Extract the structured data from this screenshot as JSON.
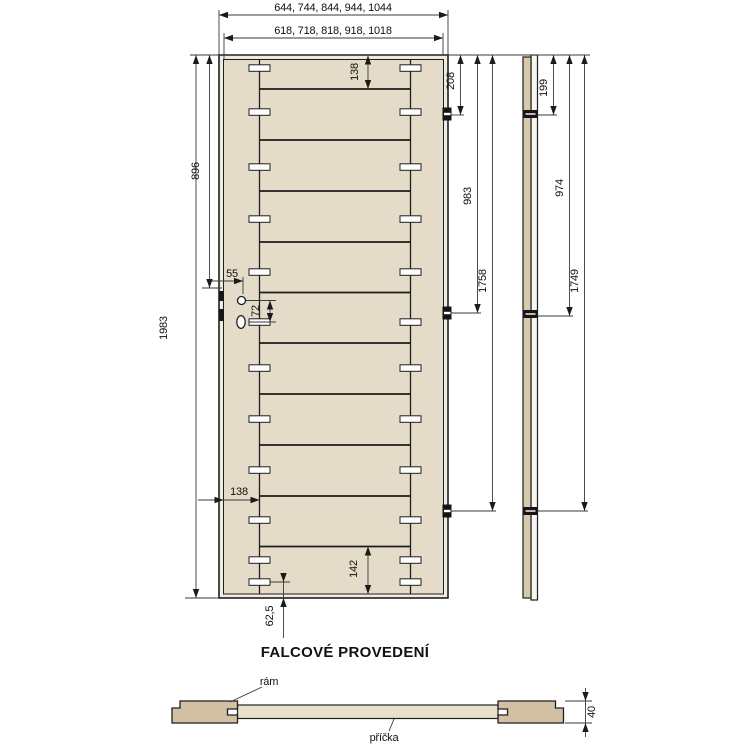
{
  "title": "FALCOVÉ PROVEDENÍ",
  "front_view": {
    "dim_width_outer": "644, 744, 844, 944, 1044",
    "dim_width_inner": "618, 718, 818, 918, 1018",
    "dim_height": "1983",
    "dim_top_to_lock": "896",
    "dim_lock_backset": "55",
    "dim_handle_to_key": "72",
    "dim_top_rail": "138",
    "dim_stile_width": "138",
    "dim_bottom_rail": "142",
    "dim_bottom_dowel": "62,5",
    "hinge_dims": [
      "208",
      "983",
      "1758"
    ]
  },
  "side_view": {
    "hinge_dims": [
      "199",
      "974",
      "1749"
    ]
  },
  "section_view": {
    "dim_thickness": "40",
    "label_frame": "rám",
    "label_partition": "příčka"
  },
  "colors": {
    "background": "#ffffff",
    "line": "#1f1f1f",
    "dim_line": "#3a3a3a",
    "door_face": "#e4dcc9",
    "falc_band": "#f0ebdf",
    "section_frame": "#d3c0a3",
    "section_partition": "#e9e0cc",
    "side_strip_wood": "#d7c9ab",
    "side_strip_falc": "#f8f6f0",
    "hardware": "#151515"
  }
}
